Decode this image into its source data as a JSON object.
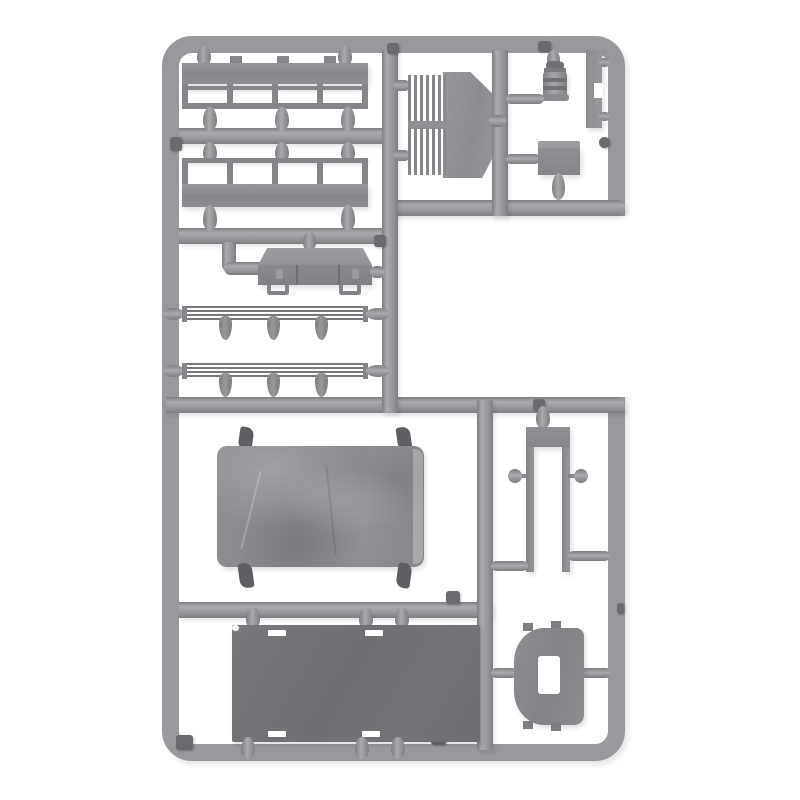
{
  "meta": {
    "description": "Product photo of a gray injection-molded plastic model kit sprue (parts tree) for a truck kit on a white background. No visible readable text; small embossed number tabs on the runners are illegible.",
    "image_type": "photograph"
  },
  "palette": {
    "background": "#ffffff",
    "runner": "#98999c",
    "runner_hi": "#aaabae",
    "runner_edge": "#7d7e81",
    "part_mid": "#8d8f92",
    "part_face": "#84868a",
    "part_dark": "#6f7174",
    "tarp": "#8a8b8e",
    "gate_dark": "#5e5f62",
    "tab_dark": "#6a6b6e"
  },
  "sprue": {
    "frame_shape": "rounded rectangle with open notch on upper-right side",
    "parts": [
      {
        "id": "stake-side-board-upper",
        "desc": "truck bed side board with stake lattice, solid plank on top"
      },
      {
        "id": "stake-side-board-lower",
        "desc": "truck bed side board with stake lattice, solid plank on bottom"
      },
      {
        "id": "radiator-louver",
        "desc": "engine radiator plate with two groups of vertical fins"
      },
      {
        "id": "fuel-canister",
        "desc": "small ribbed cylindrical canister"
      },
      {
        "id": "step-bracket-strip",
        "desc": "narrow vertical plate with step notch"
      },
      {
        "id": "battery-box",
        "desc": "small rectangular box"
      },
      {
        "id": "tool-box",
        "desc": "perspective box with panel seams and two feet"
      },
      {
        "id": "bed-side-rail-upper",
        "desc": "thin rail with three hanging stake posts"
      },
      {
        "id": "bed-side-rail-lower",
        "desc": "thin rail with three hanging stake posts"
      },
      {
        "id": "canvas-tilt-cover",
        "desc": "large wrinkled tarpaulin cover, darker gray"
      },
      {
        "id": "windshield-frame",
        "desc": "U-shaped frame with header block and two side discs"
      },
      {
        "id": "bed-floor-panel",
        "desc": "large dark flat panel with edge slots"
      },
      {
        "id": "cab-rear-panel",
        "desc": "curved panel with rectangular window cutout"
      }
    ],
    "marker_tabs": {
      "count": 10,
      "note": "small dark embossed ID tabs on runners, digits not legible"
    }
  }
}
